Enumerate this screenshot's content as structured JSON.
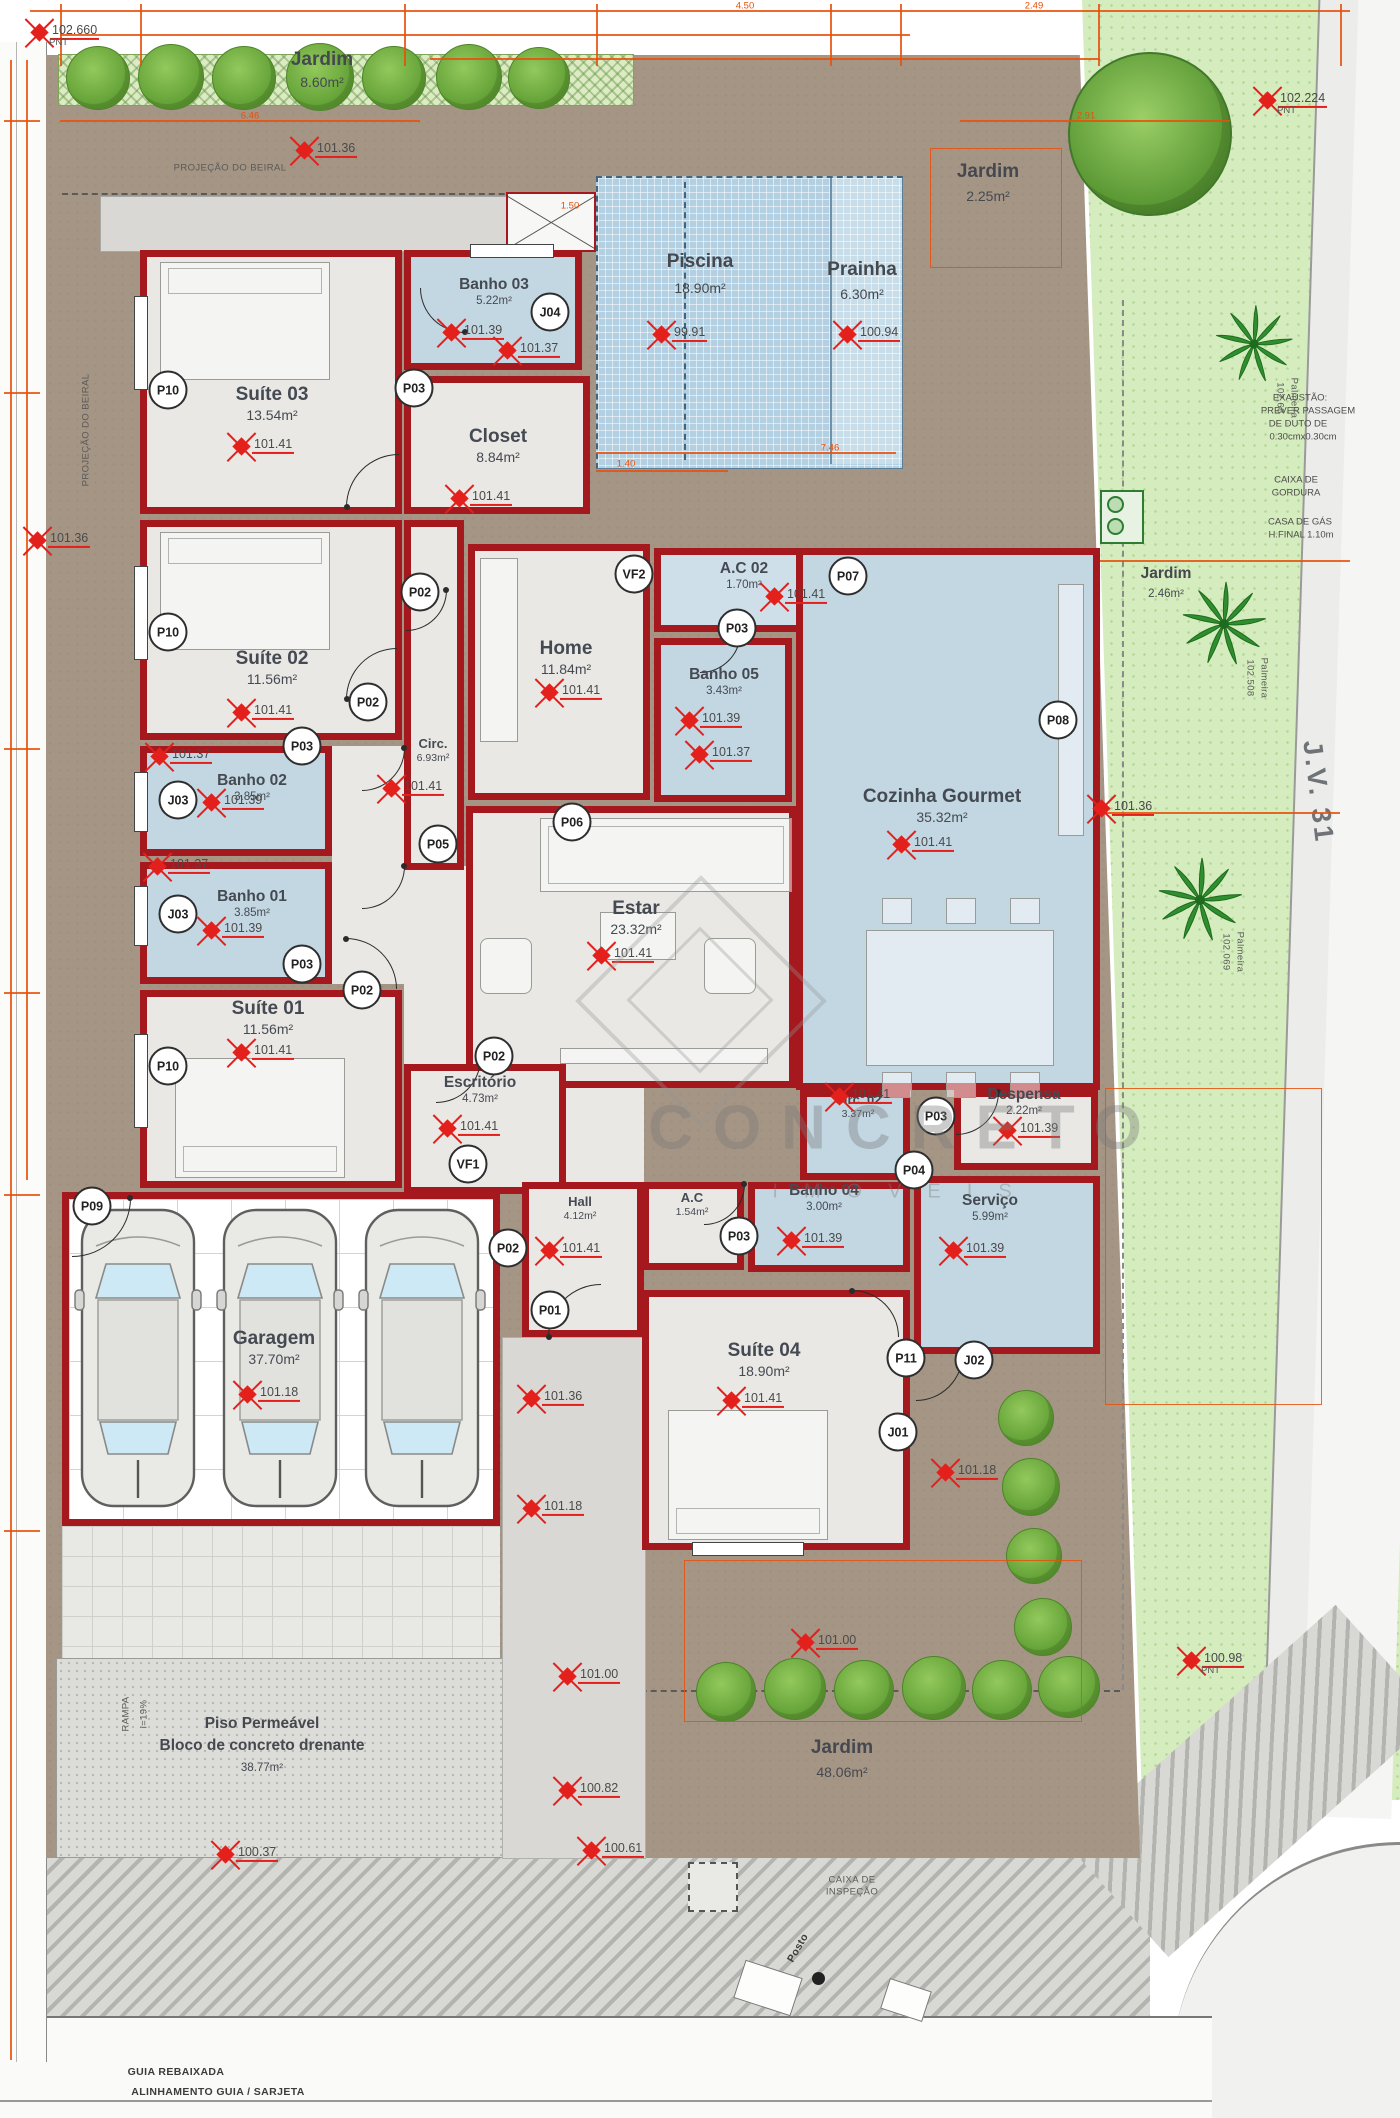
{
  "watermark": {
    "line1": "CONCRETO",
    "line2": "IMÓVEIS"
  },
  "rooms": [
    {
      "name": "Suíte 03",
      "area": "13.54m²",
      "x": 140,
      "y": 250,
      "w": 262,
      "h": 264,
      "floor": "fg",
      "lx": 272,
      "ly": 384,
      "sz": "big"
    },
    {
      "name": "Banho 03",
      "area": "5.22m²",
      "x": 404,
      "y": 250,
      "w": 178,
      "h": 120,
      "floor": "fb",
      "lx": 494,
      "ly": 276,
      "sz": "sm"
    },
    {
      "name": "Closet",
      "area": "8.84m²",
      "x": 404,
      "y": 376,
      "w": 186,
      "h": 138,
      "floor": "fg",
      "lx": 498,
      "ly": 426,
      "sz": "big"
    },
    {
      "name": "Suíte 02",
      "area": "11.56m²",
      "x": 140,
      "y": 520,
      "w": 262,
      "h": 220,
      "floor": "fg",
      "lx": 272,
      "ly": 648,
      "sz": "big"
    },
    {
      "name": "Banho 02",
      "area": "3.85m²",
      "x": 140,
      "y": 746,
      "w": 192,
      "h": 110,
      "floor": "fb",
      "lx": 252,
      "ly": 772,
      "sz": "sm"
    },
    {
      "name": "Banho 01",
      "area": "3.85m²",
      "x": 140,
      "y": 862,
      "w": 192,
      "h": 122,
      "floor": "fb",
      "lx": 252,
      "ly": 888,
      "sz": "sm"
    },
    {
      "name": "Suíte 01",
      "area": "11.56m²",
      "x": 140,
      "y": 990,
      "w": 262,
      "h": 198,
      "floor": "fg",
      "lx": 268,
      "ly": 998,
      "sz": "big"
    },
    {
      "name": "Circ.",
      "area": "6.93m²",
      "x": 404,
      "y": 520,
      "w": 60,
      "h": 350,
      "floor": "fg",
      "lx": 433,
      "ly": 736,
      "sz": "xs"
    },
    {
      "name": "Home",
      "area": "11.84m²",
      "x": 468,
      "y": 544,
      "w": 182,
      "h": 256,
      "floor": "fg",
      "lx": 566,
      "ly": 638,
      "sz": "big"
    },
    {
      "name": "A.C 02",
      "area": "1.70m²",
      "x": 654,
      "y": 548,
      "w": 220,
      "h": 84,
      "floor": "fbl",
      "lx": 744,
      "ly": 560,
      "sz": "sm"
    },
    {
      "name": "Banho 05",
      "area": "3.43m²",
      "x": 654,
      "y": 638,
      "w": 138,
      "h": 164,
      "floor": "fb",
      "lx": 724,
      "ly": 666,
      "sz": "sm"
    },
    {
      "name": "Cozinha Gourmet",
      "area": "35.32m²",
      "x": 796,
      "y": 548,
      "w": 304,
      "h": 542,
      "floor": "fb",
      "lx": 942,
      "ly": 786,
      "sz": "big"
    },
    {
      "name": "Estar",
      "area": "23.32m²",
      "x": 466,
      "y": 806,
      "w": 330,
      "h": 282,
      "floor": "fg",
      "lx": 636,
      "ly": 898,
      "sz": "big"
    },
    {
      "name": "Escritório",
      "area": "4.73m²",
      "x": 404,
      "y": 1064,
      "w": 162,
      "h": 130,
      "floor": "fg",
      "lx": 480,
      "ly": 1074,
      "sz": "sm"
    },
    {
      "name": "Circ. 02",
      "area": "3.37m²",
      "x": 800,
      "y": 1090,
      "w": 110,
      "h": 90,
      "floor": "fb",
      "lx": 858,
      "ly": 1092,
      "sz": "xs"
    },
    {
      "name": "Despensa",
      "area": "2.22m²",
      "x": 954,
      "y": 1090,
      "w": 144,
      "h": 80,
      "floor": "fg",
      "lx": 1024,
      "ly": 1086,
      "sz": "sm"
    },
    {
      "name": "A.C",
      "area": "1.54m²",
      "x": 642,
      "y": 1182,
      "w": 102,
      "h": 88,
      "floor": "fg",
      "lx": 692,
      "ly": 1190,
      "sz": "xs"
    },
    {
      "name": "Banho 04",
      "area": "3.00m²",
      "x": 748,
      "y": 1182,
      "w": 162,
      "h": 90,
      "floor": "fb",
      "lx": 824,
      "ly": 1182,
      "sz": "sm"
    },
    {
      "name": "Serviço",
      "area": "5.99m²",
      "x": 914,
      "y": 1176,
      "w": 186,
      "h": 178,
      "floor": "fb",
      "lx": 990,
      "ly": 1192,
      "sz": "sm"
    },
    {
      "name": "Hall",
      "area": "4.12m²",
      "x": 522,
      "y": 1182,
      "w": 122,
      "h": 155,
      "floor": "fg",
      "lx": 580,
      "ly": 1194,
      "sz": "xs"
    },
    {
      "name": "Suíte 04",
      "area": "18.90m²",
      "x": 642,
      "y": 1290,
      "w": 268,
      "h": 260,
      "floor": "fg",
      "lx": 764,
      "ly": 1340,
      "sz": "big"
    },
    {
      "name": "Garagem",
      "area": "37.70m²",
      "x": 62,
      "y": 1192,
      "w": 438,
      "h": 334,
      "floor": "fx",
      "lx": 274,
      "ly": 1328,
      "sz": "big"
    }
  ],
  "markers": [
    {
      "v": "102.660",
      "x": 40,
      "y": 32,
      "sub": "PNT"
    },
    {
      "v": "101.36",
      "x": 305,
      "y": 150
    },
    {
      "v": "102.224",
      "x": 1268,
      "y": 100,
      "sub": "PNT"
    },
    {
      "v": "99.91",
      "x": 662,
      "y": 334
    },
    {
      "v": "100.94",
      "x": 848,
      "y": 334
    },
    {
      "v": "101.39",
      "x": 452,
      "y": 332
    },
    {
      "v": "101.37",
      "x": 508,
      "y": 350
    },
    {
      "v": "101.41",
      "x": 242,
      "y": 446
    },
    {
      "v": "101.41",
      "x": 460,
      "y": 498
    },
    {
      "v": "101.41",
      "x": 242,
      "y": 712
    },
    {
      "v": "101.37",
      "x": 160,
      "y": 756
    },
    {
      "v": "101.39",
      "x": 212,
      "y": 802
    },
    {
      "v": "101.37",
      "x": 158,
      "y": 866
    },
    {
      "v": "101.39",
      "x": 212,
      "y": 930
    },
    {
      "v": "101.41",
      "x": 242,
      "y": 1052
    },
    {
      "v": "101.41",
      "x": 392,
      "y": 788
    },
    {
      "v": "101.41",
      "x": 550,
      "y": 692
    },
    {
      "v": "101.41",
      "x": 775,
      "y": 596
    },
    {
      "v": "101.39",
      "x": 690,
      "y": 720
    },
    {
      "v": "101.37",
      "x": 700,
      "y": 754
    },
    {
      "v": "101.41",
      "x": 902,
      "y": 844
    },
    {
      "v": "101.41",
      "x": 602,
      "y": 955
    },
    {
      "v": "101.41",
      "x": 448,
      "y": 1128
    },
    {
      "v": "101.41",
      "x": 840,
      "y": 1096
    },
    {
      "v": "101.39",
      "x": 1008,
      "y": 1130
    },
    {
      "v": "101.39",
      "x": 792,
      "y": 1240
    },
    {
      "v": "101.39",
      "x": 954,
      "y": 1250
    },
    {
      "v": "101.41",
      "x": 550,
      "y": 1250
    },
    {
      "v": "101.41",
      "x": 732,
      "y": 1400
    },
    {
      "v": "101.18",
      "x": 248,
      "y": 1394
    },
    {
      "v": "101.36",
      "x": 1102,
      "y": 808
    },
    {
      "v": "101.36",
      "x": 532,
      "y": 1398
    },
    {
      "v": "101.18",
      "x": 532,
      "y": 1508
    },
    {
      "v": "101.18",
      "x": 946,
      "y": 1472
    },
    {
      "v": "101.00",
      "x": 806,
      "y": 1642
    },
    {
      "v": "101.00",
      "x": 568,
      "y": 1676
    },
    {
      "v": "100.82",
      "x": 568,
      "y": 1790
    },
    {
      "v": "100.61",
      "x": 592,
      "y": 1850
    },
    {
      "v": "100.37",
      "x": 226,
      "y": 1854
    },
    {
      "v": "100.98",
      "x": 1192,
      "y": 1660,
      "sub": "PNT"
    },
    {
      "v": "101.36",
      "x": 38,
      "y": 540
    }
  ],
  "tags": [
    {
      "t": "P10",
      "x": 168,
      "y": 390
    },
    {
      "t": "P10",
      "x": 168,
      "y": 632
    },
    {
      "t": "P10",
      "x": 168,
      "y": 1066
    },
    {
      "t": "P03",
      "x": 414,
      "y": 388
    },
    {
      "t": "P03",
      "x": 302,
      "y": 746
    },
    {
      "t": "P03",
      "x": 302,
      "y": 964
    },
    {
      "t": "P03",
      "x": 737,
      "y": 628
    },
    {
      "t": "P03",
      "x": 739,
      "y": 1236
    },
    {
      "t": "P03",
      "x": 936,
      "y": 1116
    },
    {
      "t": "P02",
      "x": 420,
      "y": 592
    },
    {
      "t": "P02",
      "x": 368,
      "y": 702
    },
    {
      "t": "P02",
      "x": 362,
      "y": 990
    },
    {
      "t": "P02",
      "x": 494,
      "y": 1056
    },
    {
      "t": "P02",
      "x": 508,
      "y": 1248
    },
    {
      "t": "P05",
      "x": 438,
      "y": 844
    },
    {
      "t": "P06",
      "x": 572,
      "y": 822
    },
    {
      "t": "P07",
      "x": 848,
      "y": 576
    },
    {
      "t": "P08",
      "x": 1058,
      "y": 720
    },
    {
      "t": "P09",
      "x": 92,
      "y": 1206
    },
    {
      "t": "P01",
      "x": 550,
      "y": 1310
    },
    {
      "t": "P11",
      "x": 906,
      "y": 1358
    },
    {
      "t": "P04",
      "x": 914,
      "y": 1170
    },
    {
      "t": "J04",
      "x": 550,
      "y": 312
    },
    {
      "t": "J03",
      "x": 178,
      "y": 800
    },
    {
      "t": "J03",
      "x": 178,
      "y": 914
    },
    {
      "t": "J02",
      "x": 974,
      "y": 1360
    },
    {
      "t": "J01",
      "x": 898,
      "y": 1432
    },
    {
      "t": "VF2",
      "x": 634,
      "y": 574
    },
    {
      "t": "VF1",
      "x": 468,
      "y": 1164
    }
  ],
  "texts": [
    {
      "t": "Jardim",
      "x": 322,
      "y": 60,
      "cls": "rl"
    },
    {
      "t": "8.60m²",
      "x": 322,
      "y": 82,
      "cls": "ra"
    },
    {
      "t": "Jardim",
      "x": 988,
      "y": 172,
      "cls": "rl"
    },
    {
      "t": "2.25m²",
      "x": 988,
      "y": 196,
      "cls": "ra"
    },
    {
      "t": "Piscina",
      "x": 700,
      "y": 262,
      "cls": "rl"
    },
    {
      "t": "18.90m²",
      "x": 700,
      "y": 288,
      "cls": "ra"
    },
    {
      "t": "Prainha",
      "x": 862,
      "y": 270,
      "cls": "rl"
    },
    {
      "t": "6.30m²",
      "x": 862,
      "y": 294,
      "cls": "ra"
    },
    {
      "t": "PROJEÇÃO DO BEIRAL",
      "x": 230,
      "y": 168,
      "cls": "tiny"
    },
    {
      "t": "PROJEÇÃO DO BEIRAL",
      "x": 86,
      "y": 430,
      "cls": "tiny",
      "rot": -90
    },
    {
      "t": "EXAUSTÃO:",
      "x": 1300,
      "y": 398,
      "cls": "note"
    },
    {
      "t": "PREVER PASSAGEM",
      "x": 1308,
      "y": 411,
      "cls": "note"
    },
    {
      "t": "DE DUTO DE",
      "x": 1298,
      "y": 424,
      "cls": "note"
    },
    {
      "t": "0.30cmx0.30cm",
      "x": 1303,
      "y": 437,
      "cls": "note"
    },
    {
      "t": "CAIXA DE",
      "x": 1296,
      "y": 480,
      "cls": "note"
    },
    {
      "t": "GORDURA",
      "x": 1296,
      "y": 493,
      "cls": "note"
    },
    {
      "t": "CASA DE GÁS",
      "x": 1300,
      "y": 522,
      "cls": "note"
    },
    {
      "t": "H.FINAL 1.10m",
      "x": 1301,
      "y": 535,
      "cls": "note"
    },
    {
      "t": "Jardim",
      "x": 1166,
      "y": 574,
      "cls": "rls"
    },
    {
      "t": "2.46m²",
      "x": 1166,
      "y": 594,
      "cls": "ras"
    },
    {
      "t": "J.V. 31",
      "x": 1318,
      "y": 792,
      "cls": "street",
      "rot": 83
    },
    {
      "t": "102.68",
      "x": 1280,
      "y": 398,
      "cls": "tiny",
      "rot": 90
    },
    {
      "t": "Palmeira",
      "x": 1294,
      "y": 398,
      "cls": "tiny",
      "rot": 90
    },
    {
      "t": "102.508",
      "x": 1250,
      "y": 678,
      "cls": "tiny",
      "rot": 90
    },
    {
      "t": "Palmeira",
      "x": 1264,
      "y": 678,
      "cls": "tiny",
      "rot": 90
    },
    {
      "t": "102.069",
      "x": 1226,
      "y": 952,
      "cls": "tiny",
      "rot": 90
    },
    {
      "t": "Palmeira",
      "x": 1240,
      "y": 952,
      "cls": "tiny",
      "rot": 90
    },
    {
      "t": "Jardim",
      "x": 842,
      "y": 1748,
      "cls": "rl"
    },
    {
      "t": "48.06m²",
      "x": 842,
      "y": 1772,
      "cls": "ra"
    },
    {
      "t": "Piso Permeável",
      "x": 262,
      "y": 1724,
      "cls": "rls"
    },
    {
      "t": "Bloco de concreto drenante",
      "x": 262,
      "y": 1746,
      "cls": "rls"
    },
    {
      "t": "38.77m²",
      "x": 262,
      "y": 1768,
      "cls": "ras"
    },
    {
      "t": "RAMPA",
      "x": 126,
      "y": 1714,
      "cls": "tiny",
      "rot": -90
    },
    {
      "t": "i=19%",
      "x": 144,
      "y": 1714,
      "cls": "tiny",
      "rot": -90
    },
    {
      "t": "CAIXA DE",
      "x": 852,
      "y": 1880,
      "cls": "tiny"
    },
    {
      "t": "INSPEÇÃO",
      "x": 852,
      "y": 1892,
      "cls": "tiny"
    },
    {
      "t": "Posto",
      "x": 798,
      "y": 1948,
      "cls": "tiny2",
      "rot": -60
    },
    {
      "t": "GUIA REBAIXADA",
      "x": 176,
      "y": 2072,
      "cls": "tiny2"
    },
    {
      "t": "ALINHAMENTO GUIA / SARJETA",
      "x": 218,
      "y": 2092,
      "cls": "tiny2"
    }
  ],
  "dims": [
    {
      "t": "4.50",
      "x": 745,
      "y": 6
    },
    {
      "t": "2.49",
      "x": 1034,
      "y": 6
    },
    {
      "t": "6.46",
      "x": 250,
      "y": 116
    },
    {
      "t": "2.91",
      "x": 1086,
      "y": 116
    },
    {
      "t": "1.50",
      "x": 570,
      "y": 206
    },
    {
      "t": "1.40",
      "x": 626,
      "y": 464
    },
    {
      "t": "7.46",
      "x": 830,
      "y": 448
    }
  ],
  "doors": [
    {
      "x": 346,
      "y": 454,
      "r": 52,
      "a": 0
    },
    {
      "x": 346,
      "y": 648,
      "r": 50,
      "a": 0
    },
    {
      "x": 362,
      "y": 748,
      "r": 42,
      "a": 180
    },
    {
      "x": 362,
      "y": 866,
      "r": 42,
      "a": 180
    },
    {
      "x": 346,
      "y": 938,
      "r": 50,
      "a": 90
    },
    {
      "x": 436,
      "y": 1058,
      "r": 44,
      "a": 180
    },
    {
      "x": 420,
      "y": 288,
      "r": 44,
      "a": 270
    },
    {
      "x": 700,
      "y": 632,
      "r": 40,
      "a": 180
    },
    {
      "x": 704,
      "y": 1184,
      "r": 40,
      "a": 180
    },
    {
      "x": 956,
      "y": 1092,
      "r": 42,
      "a": 180
    },
    {
      "x": 548,
      "y": 1284,
      "r": 52,
      "a": 0
    },
    {
      "x": 916,
      "y": 1354,
      "r": 46,
      "a": 180
    },
    {
      "x": 72,
      "y": 1198,
      "r": 58,
      "a": 180
    },
    {
      "x": 852,
      "y": 1290,
      "r": 46,
      "a": 90
    },
    {
      "x": 406,
      "y": 590,
      "r": 40,
      "a": 180
    }
  ]
}
